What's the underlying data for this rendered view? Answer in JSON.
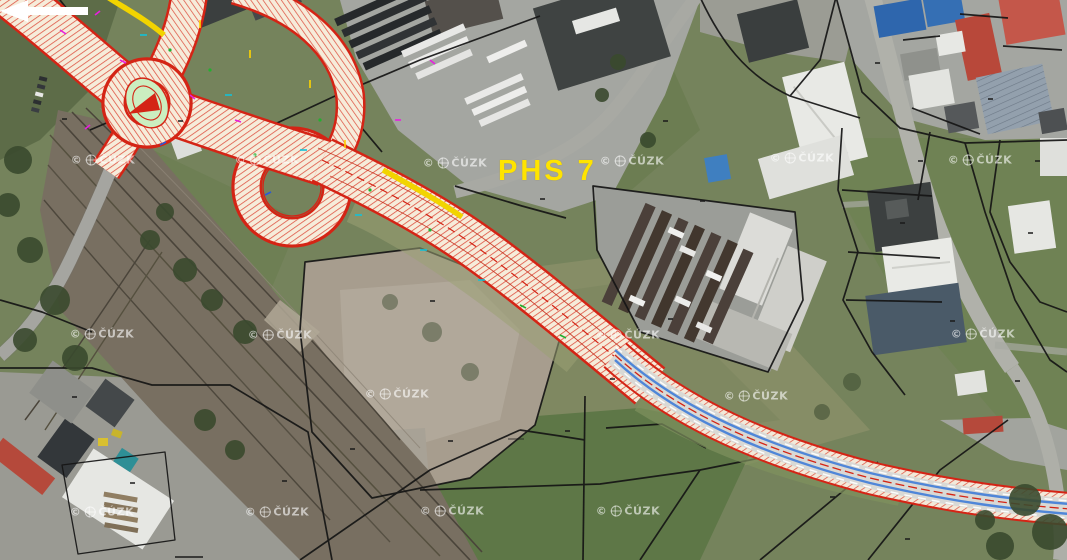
{
  "scene": {
    "description": "Aerial orthophoto with highway interchange construction design overlay",
    "overlay_label": {
      "text": "PHS 7",
      "color": "#ffe400",
      "arrow_color": "#ffffff",
      "arrow_direction": "left"
    },
    "watermark": {
      "text": "© ČÚZK",
      "copyright": "©",
      "org": "ČÚZK",
      "positions": [
        [
          103,
          160
        ],
        [
          267,
          160
        ],
        [
          455,
          163
        ],
        [
          632,
          161
        ],
        [
          802,
          158
        ],
        [
          980,
          160
        ],
        [
          102,
          334
        ],
        [
          280,
          335
        ],
        [
          628,
          335
        ],
        [
          983,
          334
        ],
        [
          397,
          394
        ],
        [
          756,
          396
        ],
        [
          102,
          512
        ],
        [
          277,
          512
        ],
        [
          452,
          511
        ],
        [
          628,
          511
        ]
      ]
    },
    "legend_colors": {
      "design_red": "#d42415",
      "design_surface_cream": "#f6ecda",
      "noise_barrier_yellow": "#f2d400",
      "guideline_blue": "#4f86d8",
      "island_green": "#cbeec0",
      "cadastre_black": "#151515"
    }
  }
}
